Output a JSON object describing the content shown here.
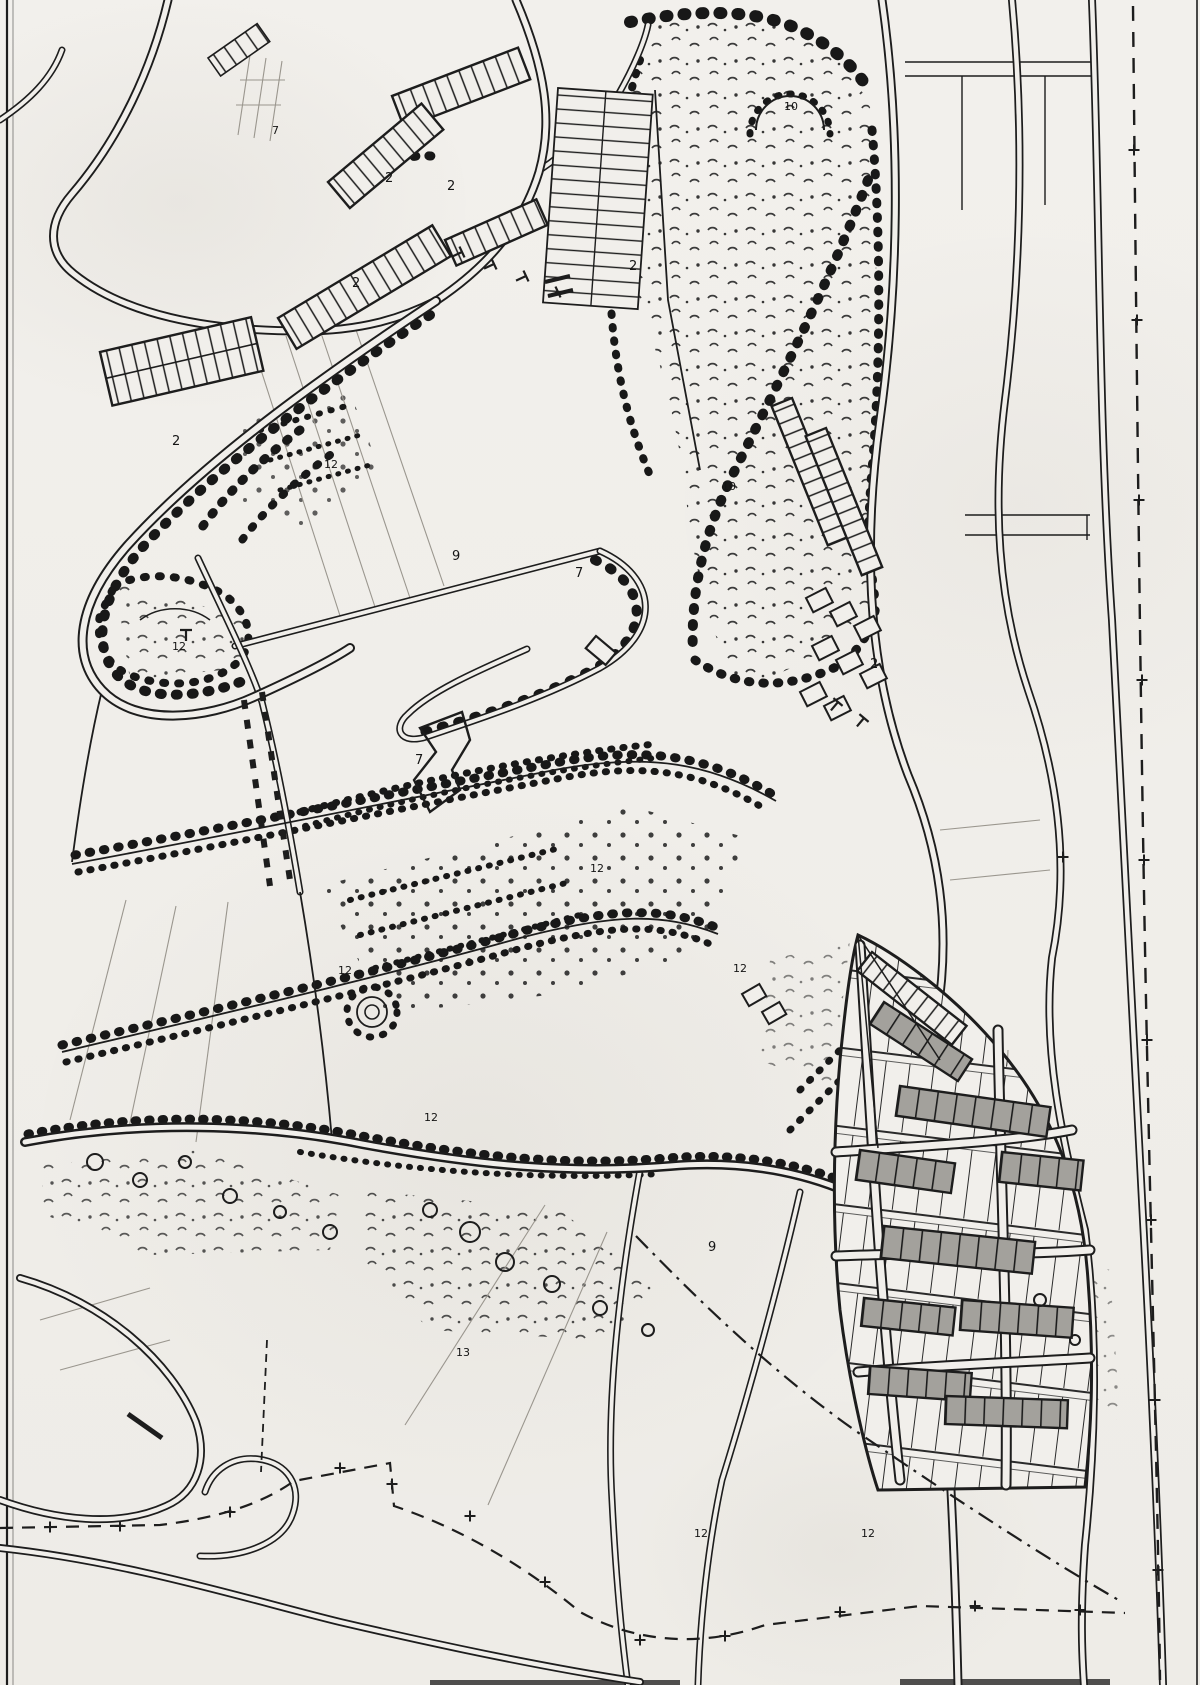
{
  "colors": {
    "paper": "#f1efeb",
    "ink": "#1d1d1d",
    "plot_shade": "#a3a19c",
    "faint_line": "#9a968e"
  },
  "legend": {
    "road_icon": "double-contour-line",
    "tree_row_icon": "dotted-tree-chain",
    "forest_icon": "scribble-tree-scatter",
    "orchard_icon": "regular-dot-rows",
    "building_block_icon": "hatched-bar",
    "parking_icon": "ruled-stall-rows",
    "allotment_icon": "ruled-grid-with-shaded-plots",
    "boundary_icon": "dashed-line-with-cross-ticks",
    "spiral_icon": "concentric-mound-rings"
  },
  "labels": [
    {
      "text": "2",
      "area": "top-left row housing, upper bar"
    },
    {
      "text": "2",
      "area": "top-left row housing, right bar"
    },
    {
      "text": "2",
      "area": "top-left row housing, lower bar"
    },
    {
      "text": "2",
      "area": "top-centre field strips"
    },
    {
      "text": "7",
      "area": "top-left parcel strip"
    },
    {
      "text": "2",
      "area": "west parking court"
    },
    {
      "text": "12",
      "area": "west loop gardens"
    },
    {
      "text": "12",
      "area": "loop meadow triangle"
    },
    {
      "text": "9",
      "area": "central diagonal road"
    },
    {
      "text": "7",
      "area": "central meadow"
    },
    {
      "text": "10",
      "area": "forest court with半circle drive"
    },
    {
      "text": "10",
      "area": "eastern terraces, upper"
    },
    {
      "text": "7",
      "area": "central pond knoll"
    },
    {
      "text": "12",
      "area": "orchard avenue north-east"
    },
    {
      "text": "12",
      "area": "orchard spiral knoll west"
    },
    {
      "text": "12",
      "area": "orchard avenue east"
    },
    {
      "text": "2",
      "area": "eastern terraces, lower"
    },
    {
      "text": "12",
      "area": "orchard avenue south-west"
    },
    {
      "text": "9",
      "area": "southern avenue, west"
    },
    {
      "text": "9",
      "area": "southern avenue, east"
    },
    {
      "text": "13",
      "area": "southern meadow"
    },
    {
      "text": "12",
      "area": "allotment garden south edge"
    },
    {
      "text": "12",
      "area": "southern tree belt"
    }
  ]
}
